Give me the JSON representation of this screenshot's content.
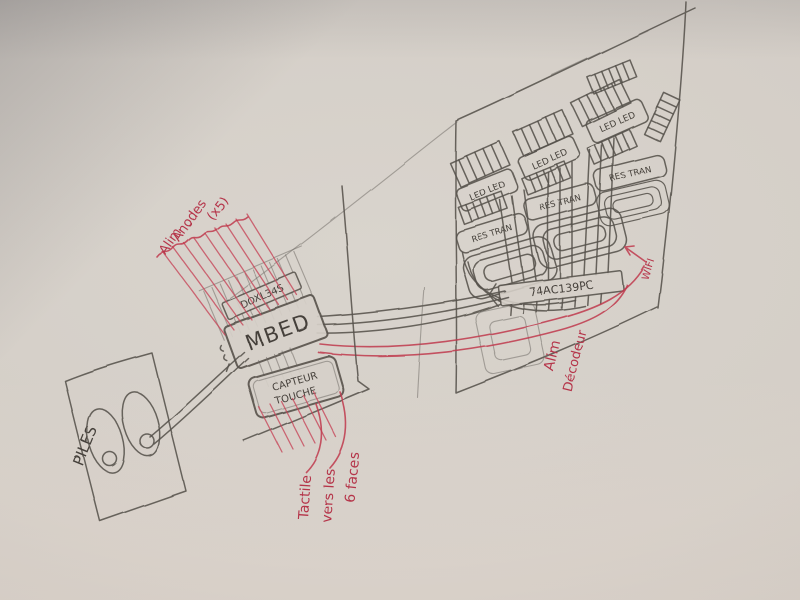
{
  "colors": {
    "paper": "#d5cfc8",
    "pencil": "#57524c",
    "red_ink": "#c03a4e"
  },
  "battery": {
    "label": "PILES"
  },
  "mbed_stack": {
    "driver_label": "DOXL34S",
    "board_label": "MBED",
    "sensor_line1": "CAPTEUR",
    "sensor_line2": "TOUCHE"
  },
  "led_panel": {
    "chip_label": "74AC139PC",
    "led_box_label": "LED LED",
    "res_tran_label": "RES TRAN"
  },
  "annotations": {
    "alim_anodes": {
      "line1": "Alim",
      "line2": "Anodes",
      "line3": "(x5)"
    },
    "tactile": {
      "line1": "Tactile",
      "line2": "vers les",
      "line3": "6 faces"
    },
    "alim_decodeur": {
      "line1": "Alim",
      "line2": "Décodeur"
    },
    "wifi": "WIFI"
  }
}
